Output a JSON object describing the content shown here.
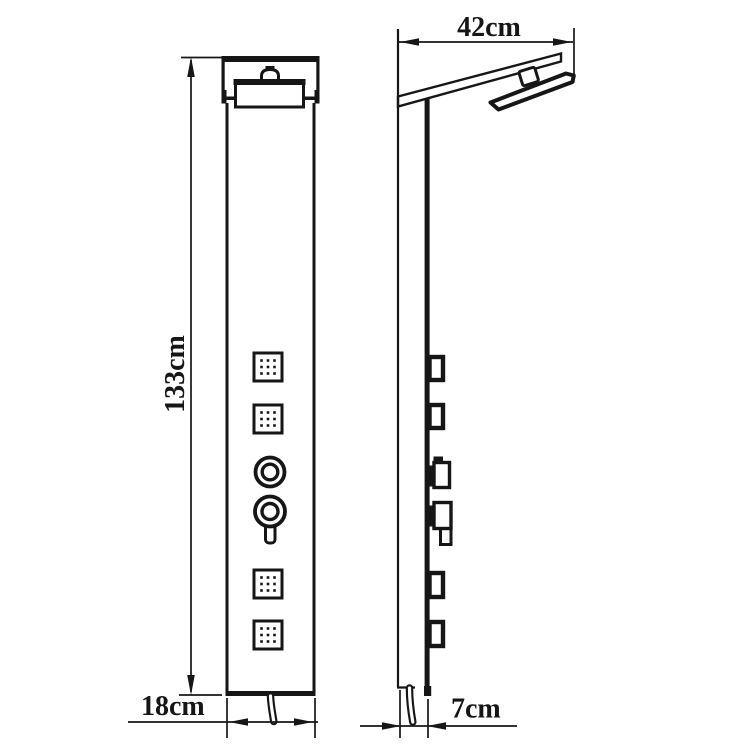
{
  "canvas": {
    "background": "#ffffff",
    "line_color": "#161616"
  },
  "drawing": {
    "kind": "shower-panel-dimension-diagram",
    "labels": {
      "height": "133cm",
      "top_width": "42cm",
      "panel_width": "18cm",
      "panel_depth": "7cm"
    }
  }
}
